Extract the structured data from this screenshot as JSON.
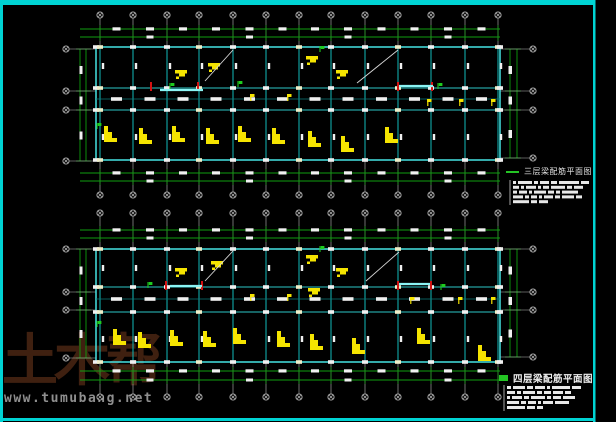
{
  "watermark": {
    "brand": "土木帮",
    "url": "www.tumubang.net"
  },
  "titles": {
    "plan1": {
      "label": "三层梁配筋平面图"
    },
    "plan2": {
      "label": "四层梁配筋平面图"
    }
  },
  "colors": {
    "bg": "#000000",
    "frame": "#00d4d4",
    "beam_outline": "#46e3e3",
    "beam_v": "#11a9a9",
    "beam_h": "#2cc6c6",
    "beam_mid": "#0c7d7d",
    "grid_line": "#b9b9b9",
    "dim": "#0f9e0f",
    "blob": "#f0f0f0",
    "cap_alt": "#efeec9",
    "rebar": "#f5e400",
    "red_mark": "#d41212",
    "highlight": "#8bf4f4",
    "green_mark": "#1ecb1e",
    "note": "#e8e8e8",
    "wm_brand": "#3f2010",
    "wm_url": "#8f8f8f"
  },
  "drawing": {
    "width": 616,
    "height": 422,
    "frame": {
      "right": 595,
      "bottom": 421
    },
    "grid_xs": [
      100,
      133,
      167,
      199,
      233,
      266,
      299,
      331,
      365,
      398,
      431,
      465,
      498
    ],
    "plan_left": 96,
    "plan_right": 500,
    "dim_span": [
      80,
      500
    ],
    "plans": [
      {
        "id": "plan-3f",
        "bubbles_top_y": 15,
        "bubbles_bottom_y": 195,
        "dim_top_ys": [
          29,
          37
        ],
        "dim_bottom_ys": [
          173,
          181
        ],
        "top": 47,
        "cor_top": 88,
        "cor_mid": 99,
        "cor_bot": 110,
        "bottom": 160,
        "left_bubble_x": 66,
        "left_bubble_ys": [
          49,
          91,
          110,
          161
        ],
        "right_bubble_x": 533,
        "right_bubble_ys": [
          49,
          91,
          110,
          158
        ],
        "left_dim_xs": [
          80,
          86
        ],
        "right_dim_xs": [
          510,
          517
        ],
        "diagonals": [
          [
            205,
            81,
            233,
            50
          ],
          [
            357,
            83,
            398,
            50
          ]
        ],
        "red_tick_y": 86,
        "red_tick_xs": [
          151,
          198,
          398,
          432
        ],
        "highlights": [
          [
            160,
            90,
            203
          ],
          [
            399,
            86,
            433
          ]
        ],
        "big_glyphs": [
          [
            104,
            126
          ],
          [
            139,
            128
          ],
          [
            172,
            126
          ],
          [
            206,
            128
          ],
          [
            238,
            126
          ],
          [
            272,
            128
          ],
          [
            308,
            131
          ],
          [
            341,
            136
          ],
          [
            385,
            127
          ]
        ],
        "top_glyphs": [
          [
            175,
            70
          ],
          [
            208,
            63
          ],
          [
            306,
            56
          ],
          [
            336,
            70
          ]
        ],
        "flags": [
          [
            250,
            94
          ],
          [
            287,
            94
          ],
          [
            427,
            99
          ],
          [
            459,
            99
          ],
          [
            491,
            99
          ]
        ],
        "green_marks": [
          [
            170,
            83
          ],
          [
            238,
            81
          ],
          [
            438,
            83
          ],
          [
            97,
            123
          ],
          [
            320,
            46
          ]
        ],
        "notes": {
          "x": 513,
          "y": 181,
          "row_h": 4.8,
          "rows": [
            [
              3,
              14,
              4,
              9,
              6,
              20,
              8
            ],
            [
              6,
              3,
              10,
              3,
              6,
              14,
              5,
              9
            ],
            [
              4,
              8,
              3,
              12,
              6,
              4,
              16
            ],
            [
              10,
              4,
              6,
              3,
              9,
              5,
              12,
              6
            ],
            [
              16,
              6,
              9
            ]
          ]
        }
      },
      {
        "id": "plan-4f",
        "bubbles_top_y": 213,
        "bubbles_bottom_y": 397,
        "dim_top_ys": [
          230,
          238
        ],
        "dim_bottom_ys": [
          371,
          380
        ],
        "top": 249,
        "cor_top": 287,
        "cor_mid": 299,
        "cor_bot": 312,
        "bottom": 362,
        "left_bubble_x": 66,
        "left_bubble_ys": [
          249,
          292,
          310,
          358
        ],
        "right_bubble_x": 533,
        "right_bubble_ys": [
          249,
          292,
          310,
          357
        ],
        "left_dim_xs": [
          80,
          86
        ],
        "right_dim_xs": [
          510,
          517
        ],
        "diagonals": [
          [
            205,
            281,
            233,
            251
          ],
          [
            366,
            281,
            399,
            252
          ]
        ],
        "red_tick_y": 285,
        "red_tick_xs": [
          166,
          202,
          398,
          431
        ],
        "highlights": [
          [
            170,
            286,
            202
          ],
          [
            399,
            284,
            430
          ]
        ],
        "big_glyphs": [
          [
            113,
            329
          ],
          [
            138,
            332
          ],
          [
            170,
            330
          ],
          [
            203,
            331
          ],
          [
            233,
            328
          ],
          [
            277,
            331
          ],
          [
            310,
            334
          ],
          [
            352,
            338
          ],
          [
            417,
            328
          ],
          [
            478,
            345
          ]
        ],
        "top_glyphs": [
          [
            175,
            268
          ],
          [
            211,
            261
          ],
          [
            306,
            255
          ],
          [
            336,
            268
          ],
          [
            308,
            288
          ]
        ],
        "flags": [
          [
            250,
            294
          ],
          [
            287,
            294
          ],
          [
            410,
            297
          ],
          [
            458,
            297
          ],
          [
            491,
            297
          ]
        ],
        "green_marks": [
          [
            320,
            246
          ],
          [
            441,
            284
          ],
          [
            148,
            282
          ],
          [
            97,
            321
          ]
        ],
        "notes": {
          "x": 507,
          "y": 386,
          "row_h": 5,
          "rows": [
            [
              4,
              12,
              6,
              10,
              3,
              18,
              9
            ],
            [
              8,
              4,
              12,
              5,
              7,
              10,
              6
            ],
            [
              3,
              10,
              5,
              14,
              4,
              8,
              12
            ],
            [
              12,
              5,
              8,
              3,
              10,
              14
            ],
            [
              18,
              8,
              6
            ]
          ]
        }
      }
    ]
  }
}
